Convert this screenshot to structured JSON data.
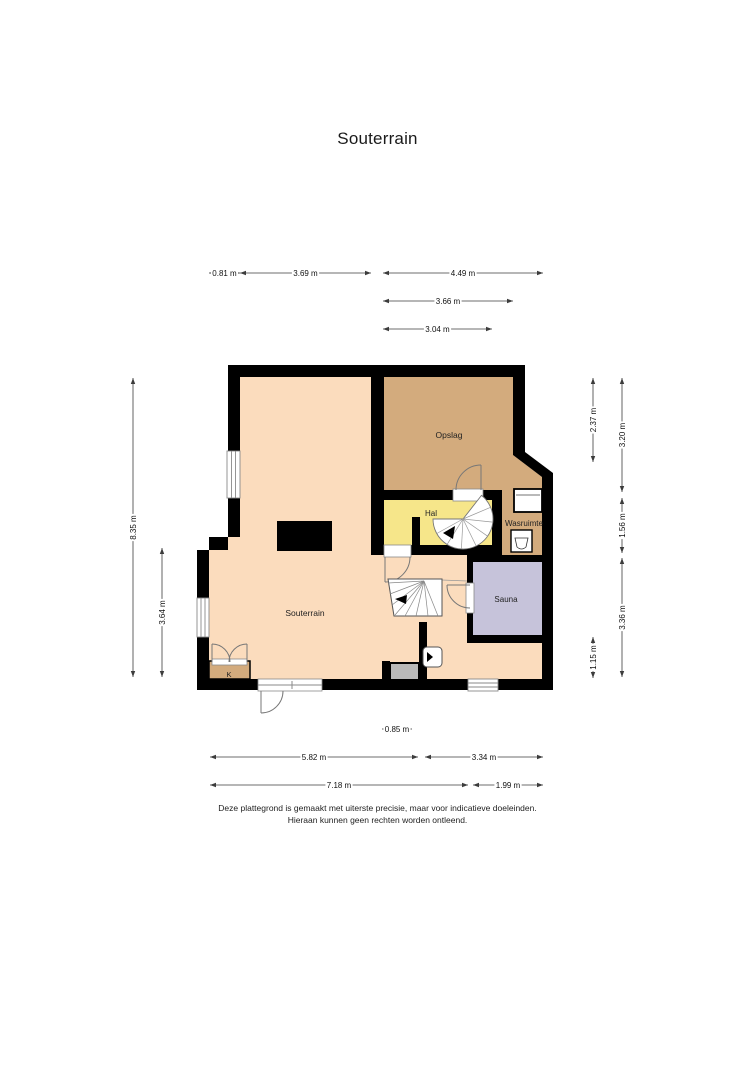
{
  "title": "Souterrain",
  "footer": {
    "line1": "Deze plattegrond is gemaakt met uiterste precisie, maar voor indicatieve doeleinden.",
    "line2": "Hieraan kunnen geen rechten worden ontleend."
  },
  "plan": {
    "rooms": [
      {
        "id": "souterrain",
        "label": "Souterrain",
        "x": 305,
        "y": 613,
        "size": 8.5
      },
      {
        "id": "opslag",
        "label": "Opslag",
        "x": 449,
        "y": 435,
        "size": 8.5
      },
      {
        "id": "hal",
        "label": "Hal",
        "x": 431,
        "y": 513,
        "size": 8
      },
      {
        "id": "wasruimte",
        "label": "Wasruimte",
        "x": 524,
        "y": 523,
        "size": 8
      },
      {
        "id": "sauna",
        "label": "Sauna",
        "x": 506,
        "y": 599,
        "size": 8
      },
      {
        "id": "kast",
        "label": "K",
        "x": 229,
        "y": 674,
        "size": 7.5
      }
    ],
    "dimensions": [
      {
        "label": "0.81 m",
        "x1": 209,
        "y1": 273,
        "x2": 240,
        "y2": 273
      },
      {
        "label": "3.69 m",
        "x1": 240,
        "y1": 273,
        "x2": 371,
        "y2": 273
      },
      {
        "label": "4.49 m",
        "x1": 383,
        "y1": 273,
        "x2": 543,
        "y2": 273
      },
      {
        "label": "3.66 m",
        "x1": 383,
        "y1": 301,
        "x2": 513,
        "y2": 301
      },
      {
        "label": "3.04 m",
        "x1": 383,
        "y1": 329,
        "x2": 492,
        "y2": 329
      },
      {
        "label": "8.35 m",
        "x1": 133,
        "y1": 378,
        "x2": 133,
        "y2": 677
      },
      {
        "label": "3.64 m",
        "x1": 162,
        "y1": 548,
        "x2": 162,
        "y2": 677
      },
      {
        "label": "2.37 m",
        "x1": 593,
        "y1": 378,
        "x2": 593,
        "y2": 462
      },
      {
        "label": "1.15 m",
        "x1": 593,
        "y1": 637,
        "x2": 593,
        "y2": 678
      },
      {
        "label": "3.20 m",
        "x1": 622,
        "y1": 378,
        "x2": 622,
        "y2": 492
      },
      {
        "label": "1.56 m",
        "x1": 622,
        "y1": 498,
        "x2": 622,
        "y2": 553
      },
      {
        "label": "3.36 m",
        "x1": 622,
        "y1": 558,
        "x2": 622,
        "y2": 677
      },
      {
        "label": "0.85 m",
        "x1": 382,
        "y1": 729,
        "x2": 412,
        "y2": 729
      },
      {
        "label": "5.82 m",
        "x1": 210,
        "y1": 757,
        "x2": 418,
        "y2": 757
      },
      {
        "label": "3.34 m",
        "x1": 425,
        "y1": 757,
        "x2": 543,
        "y2": 757
      },
      {
        "label": "7.18 m",
        "x1": 210,
        "y1": 785,
        "x2": 468,
        "y2": 785
      },
      {
        "label": "1.99 m",
        "x1": 473,
        "y1": 785,
        "x2": 543,
        "y2": 785
      }
    ],
    "colors": {
      "floor": "#fbdcbd",
      "storage": "#d3ab7d",
      "hall": "#f6e68a",
      "sauna": "#c6c3da",
      "wall": "#000000",
      "niche": "#b9b9b9",
      "dim": "#3c3c3c",
      "swing": "#777777",
      "frame": "#8a8a8a"
    },
    "symbols": [
      "spiral-staircase",
      "winder-staircase",
      "washing-machine",
      "laundry-sink",
      "chimney",
      "window",
      "door-swing",
      "double-door",
      "hatch-door",
      "niche"
    ]
  }
}
